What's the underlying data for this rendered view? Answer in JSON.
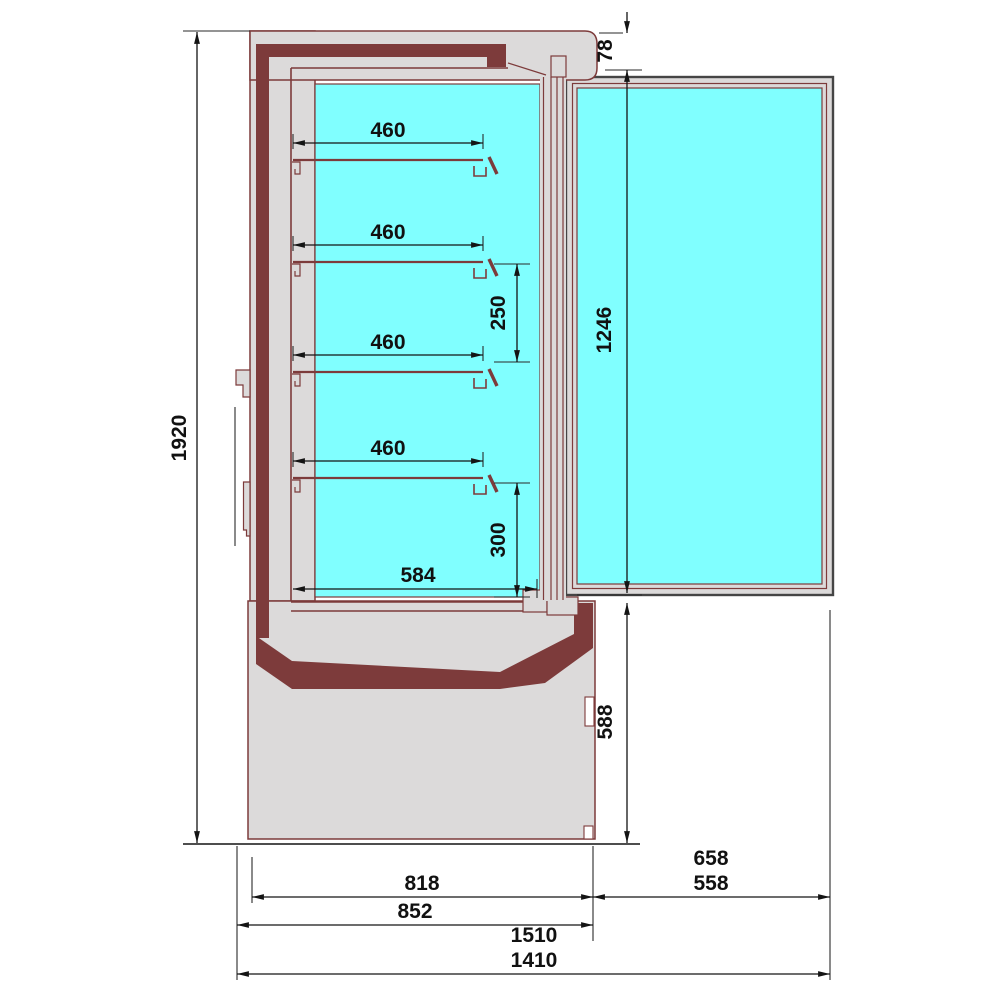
{
  "drawing": {
    "subject": "side-section technical drawing of a glass-door refrigerated display cabinet with four shelves",
    "colors": {
      "interior_glass": "#80ffff",
      "body_gray": "#dcdada",
      "insulation_maroon": "#7d3b3b",
      "door_outline": "#454545",
      "dimension_lines": "#141414",
      "background": "#ffffff"
    },
    "dims": {
      "overall_height": "1920",
      "top_offset": "78",
      "shelves": [
        "460",
        "460",
        "460",
        "460"
      ],
      "shelf_spacing": "250",
      "bottom_clearance": "300",
      "well_depth": "584",
      "door_height": "1246",
      "base_height": "588",
      "cabinet_depth": "818",
      "cabinet_depth_overall": "852",
      "door_projection_outer": "658",
      "door_projection": "558",
      "overall_depth_outer": "1510",
      "overall_depth": "1410"
    }
  }
}
